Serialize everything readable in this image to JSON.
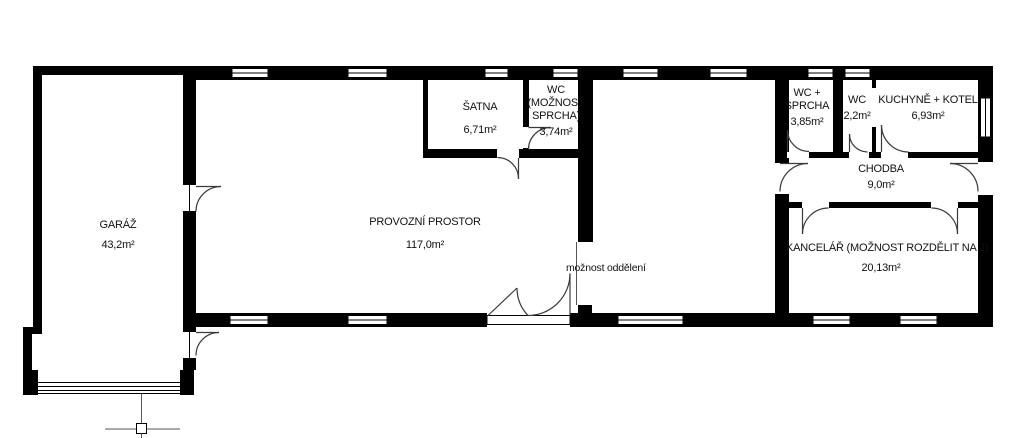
{
  "rooms": {
    "garaz": {
      "name": "GARÁŽ",
      "area": "43,2m²"
    },
    "provozni": {
      "name": "PROVOZNÍ PROSTOR",
      "area": "117,0m²"
    },
    "satna": {
      "name": "ŠATNA",
      "area": "6,71m²"
    },
    "wc_moznost": {
      "name": "WC (MOŽNOST SPRCHA)",
      "area": "3,74m²"
    },
    "wc_sprcha": {
      "name": "WC + SPRCHA",
      "area": "3,85m²"
    },
    "wc": {
      "name": "WC",
      "area": "2,2m²"
    },
    "kuchyne": {
      "name": "KUCHYNĚ + KOTEL",
      "area": "6,93m²"
    },
    "chodba": {
      "name": "CHODBA",
      "area": "9,0m²"
    },
    "kancelar": {
      "name": "KANCELÁŘ (MOŽNOST ROZDĚLIT NA 2)",
      "area": "20,13m²"
    }
  },
  "annotations": {
    "division_note": "možnost oddělení"
  },
  "colors": {
    "wall": "#000000",
    "door_line": "#3a3a3a",
    "background": "#ffffff"
  }
}
